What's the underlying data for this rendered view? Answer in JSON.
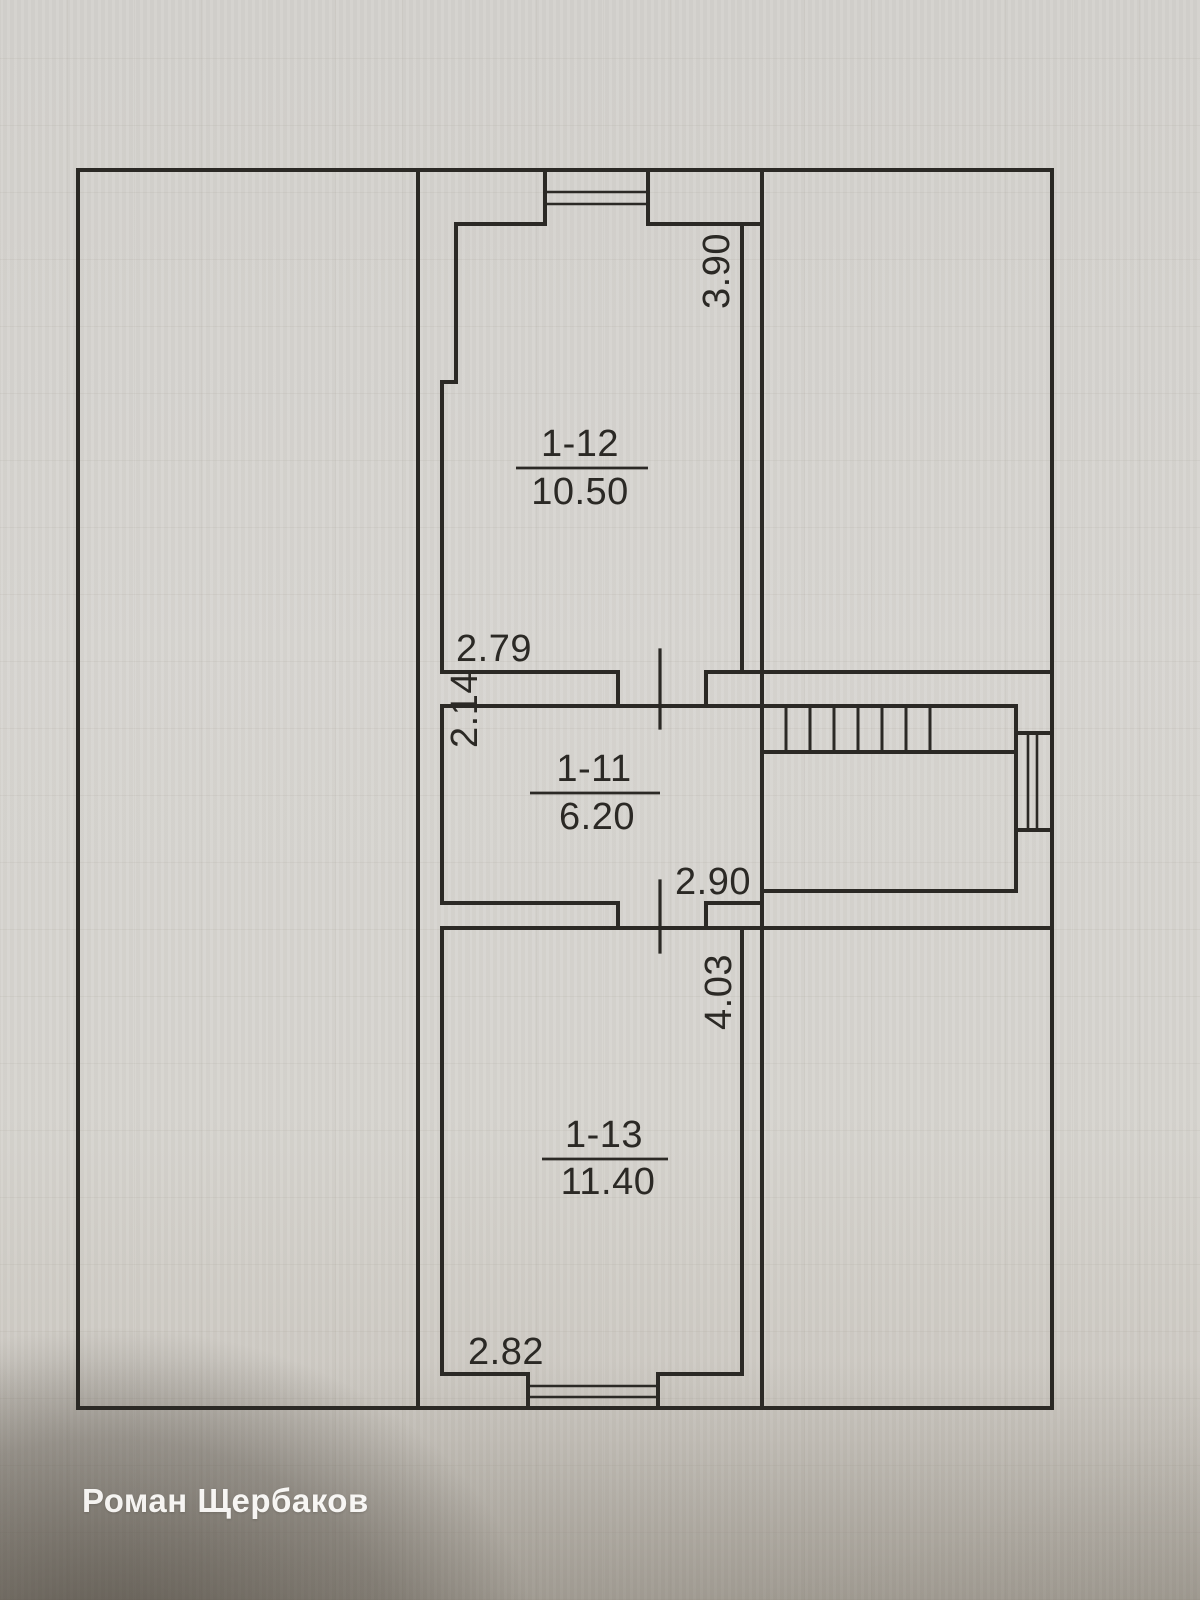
{
  "photo": {
    "watermark": "Роман Щербаков",
    "paper_color": "#d6d4d0",
    "line_color": "#2b2925"
  },
  "floor_plan": {
    "rooms": [
      {
        "id": "1-12",
        "area": "10.50",
        "width": "2.79",
        "height": "3.90"
      },
      {
        "id": "1-11",
        "area": "6.20",
        "width": "2.90",
        "height": "2.14"
      },
      {
        "id": "1-13",
        "area": "11.40",
        "width": "2.82",
        "height": "4.03"
      }
    ]
  }
}
